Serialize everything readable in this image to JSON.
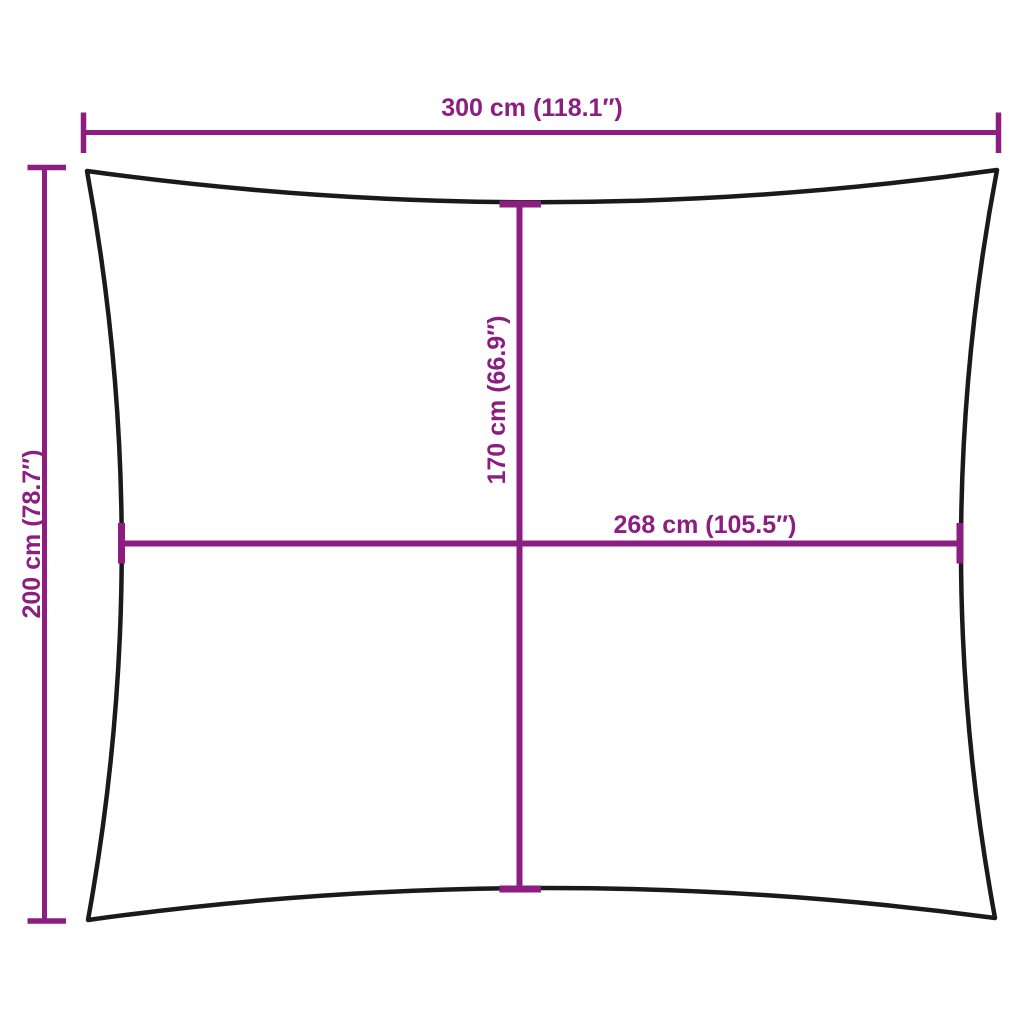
{
  "colors": {
    "dimension_lines": "#8C1E81",
    "shape_outline": "#1A1A1A",
    "background": "#FFFFFF"
  },
  "labels": {
    "top_width": "300 cm (118.1″)",
    "left_height": "200 cm (78.7″)",
    "inner_height": "170 cm (66.9″)",
    "inner_width": "268 cm (105.5″)"
  },
  "measurements": {
    "top_width": {
      "cm": 300,
      "inches": 118.1
    },
    "left_height": {
      "cm": 200,
      "inches": 78.7
    },
    "inner_height": {
      "cm": 170,
      "inches": 66.9
    },
    "inner_width": {
      "cm": 268,
      "inches": 105.5
    }
  }
}
